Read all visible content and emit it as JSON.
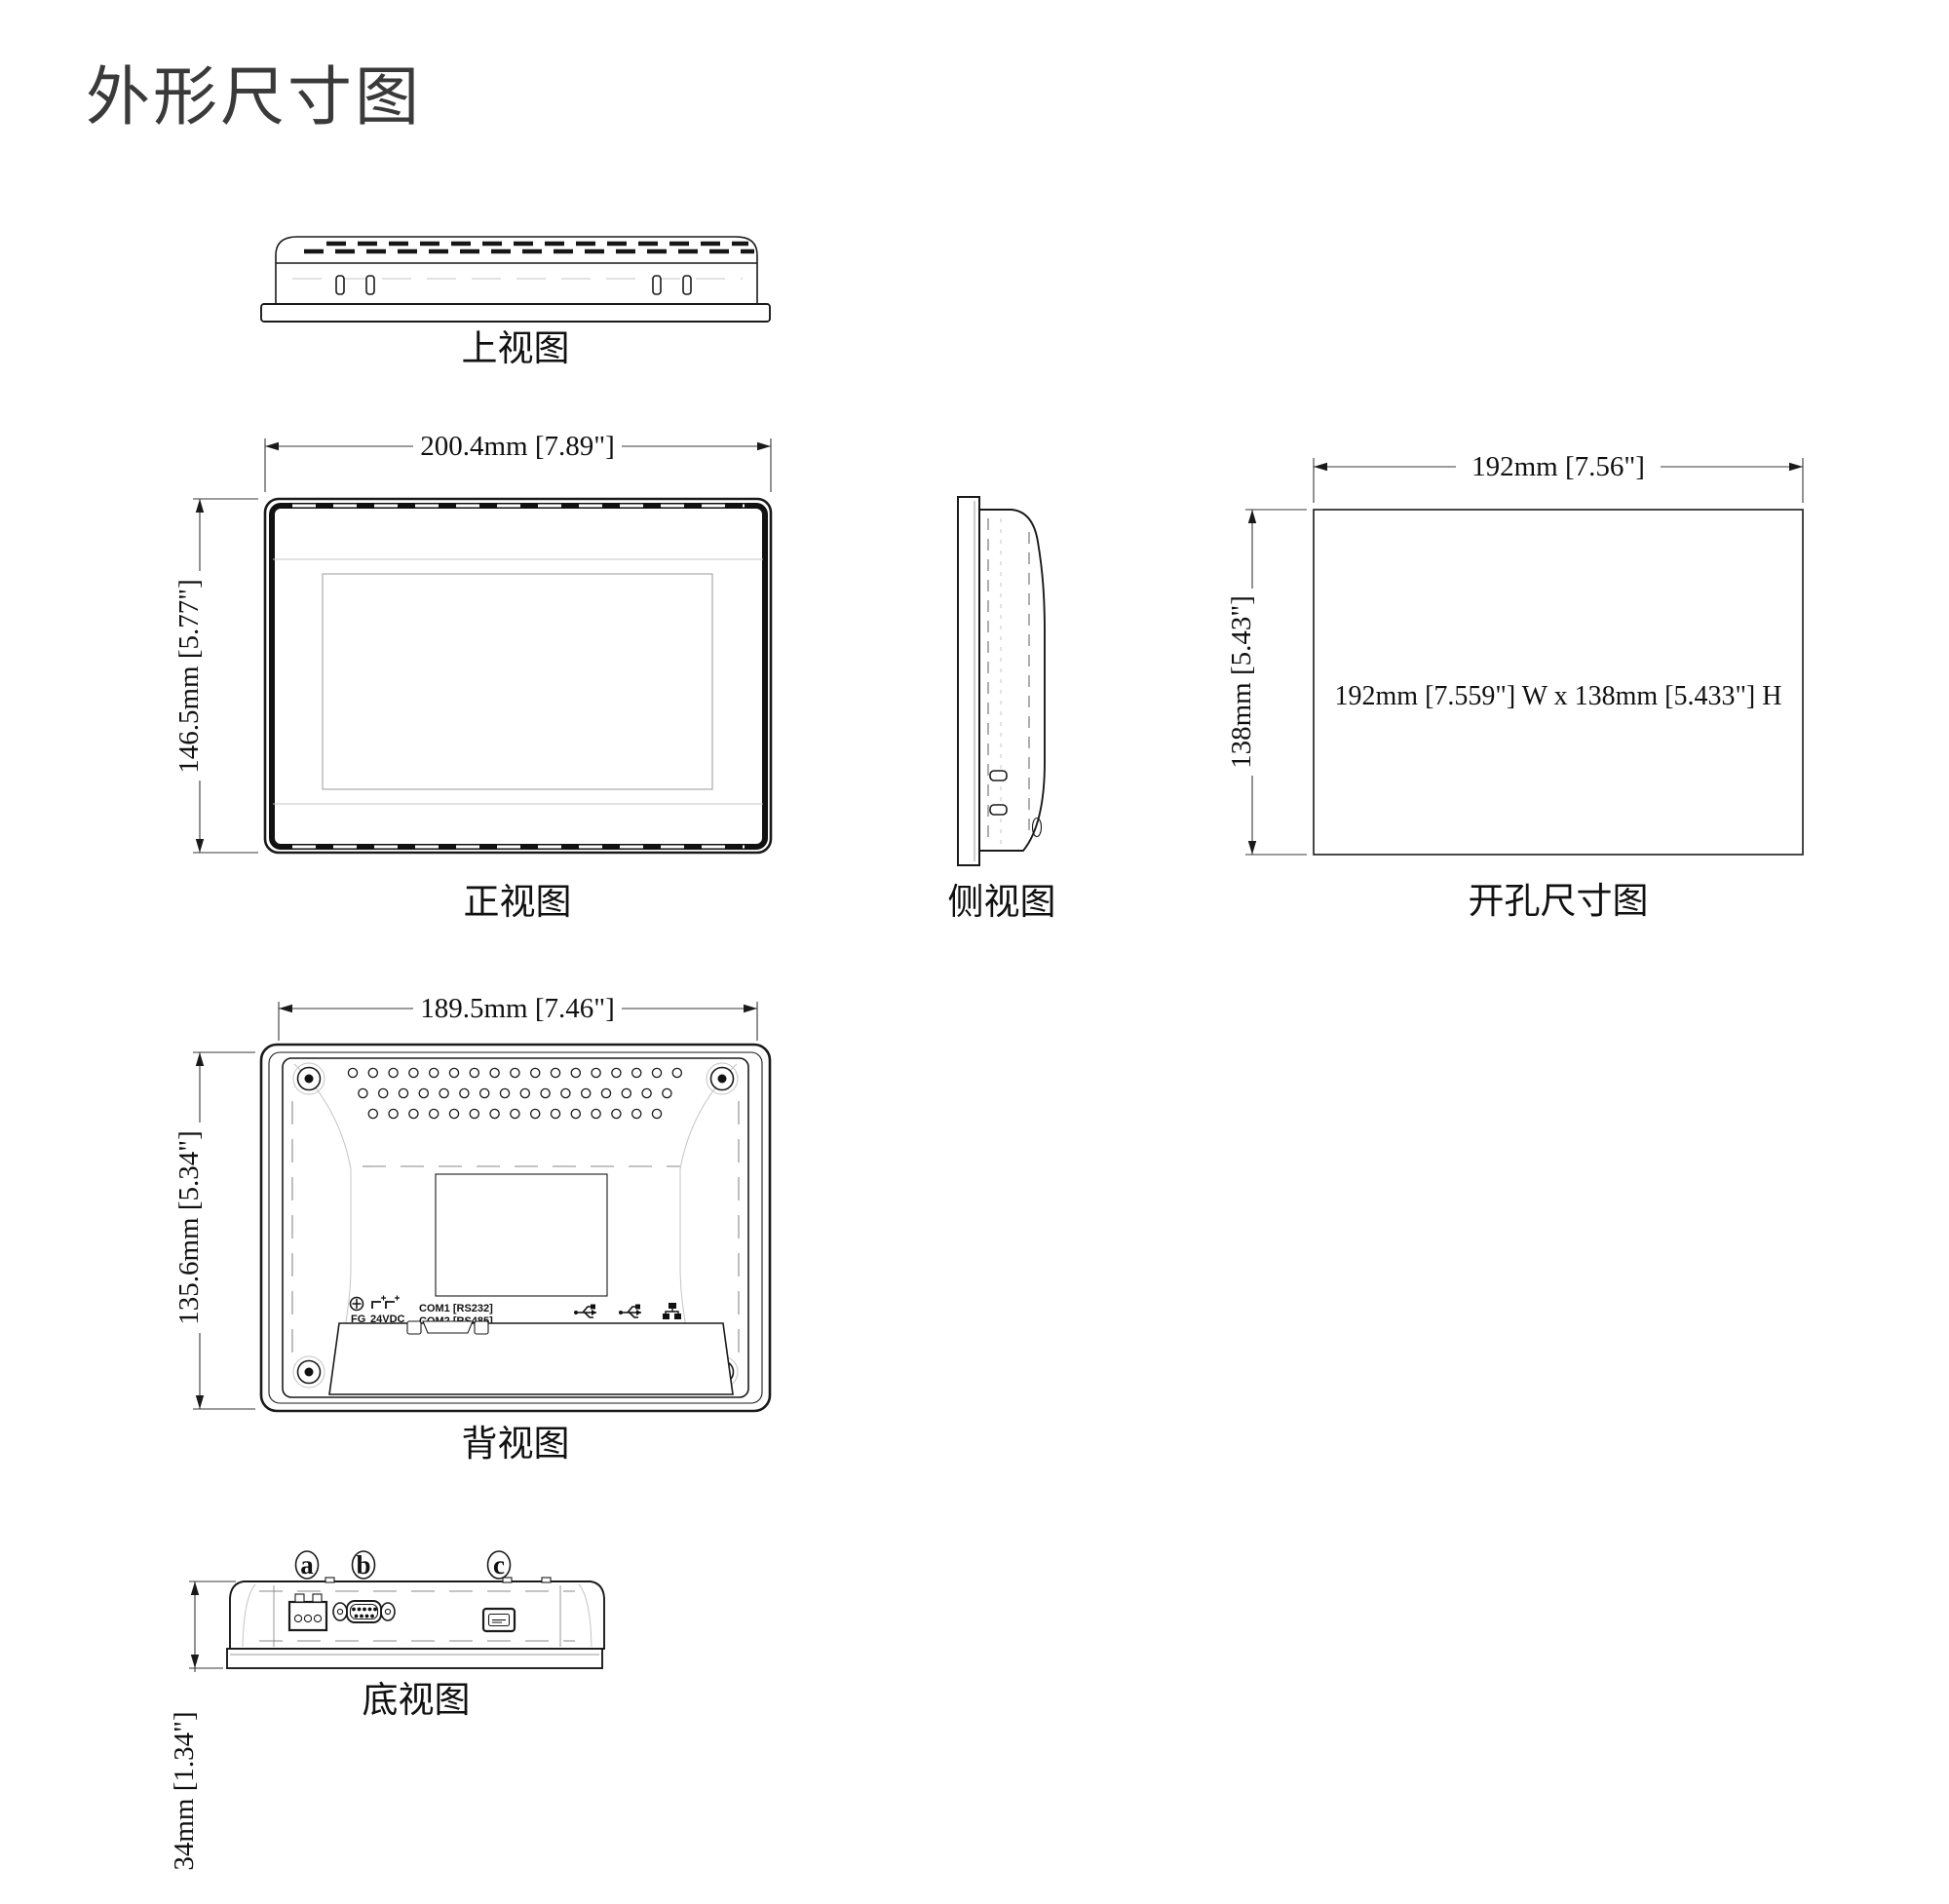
{
  "page": {
    "title": "外形尺寸图"
  },
  "colors": {
    "line": "#1a1a1a",
    "faint": "#c4c4c4",
    "dash": "#8a8a8a"
  },
  "views": {
    "top": {
      "label": "上视图"
    },
    "front": {
      "label": "正视图",
      "width_dim": "200.4mm [7.89\"]",
      "height_dim": "146.5mm [5.77\"]"
    },
    "side": {
      "label": "侧视图"
    },
    "cutout": {
      "label": "开孔尺寸图",
      "width_dim": "192mm [7.56\"]",
      "height_dim": "138mm [5.43\"]",
      "note": "192mm [7.559\"] W x 138mm [5.433\"] H"
    },
    "rear": {
      "label": "背视图",
      "width_dim": "189.5mm [7.46\"]",
      "height_dim": "135.6mm [5.34\"]",
      "markings": {
        "fg": "FG",
        "power": "24VDC",
        "com1": "COM1 [RS232]",
        "com2": "COM2 [RS485]"
      }
    },
    "bottom": {
      "label": "底视图",
      "height_dim": "34mm [1.34\"]",
      "callout_a": "a",
      "callout_b": "b",
      "callout_c": "c"
    }
  }
}
